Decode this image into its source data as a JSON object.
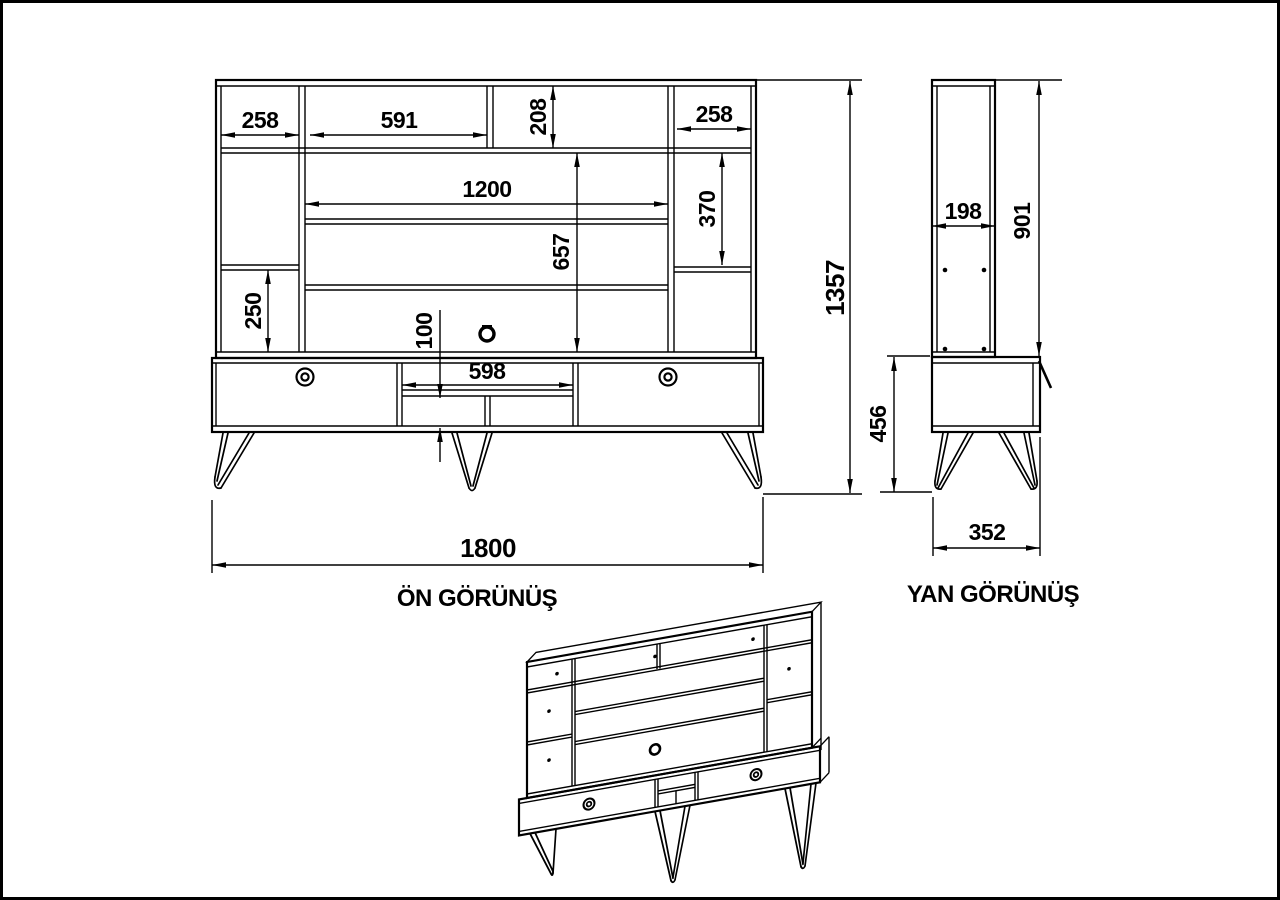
{
  "drawing": {
    "front_view": {
      "title": "ÖN GÖRÜNÜŞ",
      "dims": {
        "left_shelf_width": "258",
        "top_shelf_width": "591",
        "top_section_height": "208",
        "right_shelf_width": "258",
        "tv_opening_width": "1200",
        "right_section_height": "370",
        "tv_section_height": "657",
        "left_section_height": "250",
        "base_opening_height": "100",
        "base_opening_width": "598",
        "total_height": "1357",
        "total_width": "1800"
      }
    },
    "side_view": {
      "title": "YAN GÖRÜNÜŞ",
      "dims": {
        "upper_depth": "198",
        "upper_height": "901",
        "base_height": "456",
        "base_depth": "352"
      }
    }
  }
}
